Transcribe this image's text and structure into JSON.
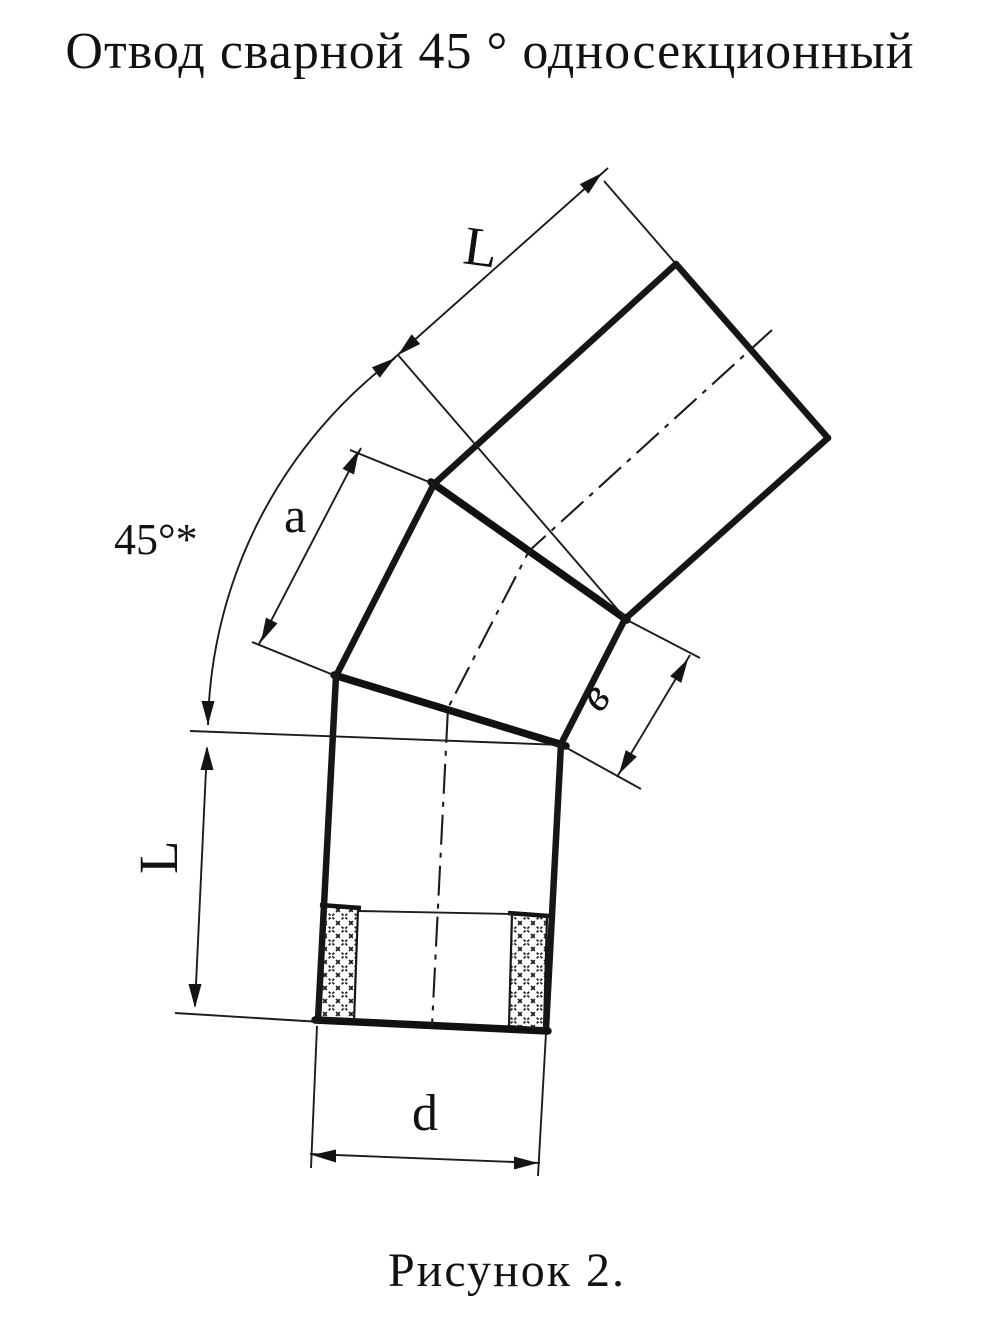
{
  "title": "Отвод сварной 45 ° односекционный",
  "caption": "Рисунок 2.",
  "colors": {
    "paper": "#ffffff",
    "ink": "#161616"
  },
  "dimensions": {
    "top_section_length": "L",
    "bend_angle": "45°*",
    "middle_section_edge": "a",
    "middle_section_width": "в",
    "bottom_section_length": "L",
    "bore_diameter": "d"
  }
}
